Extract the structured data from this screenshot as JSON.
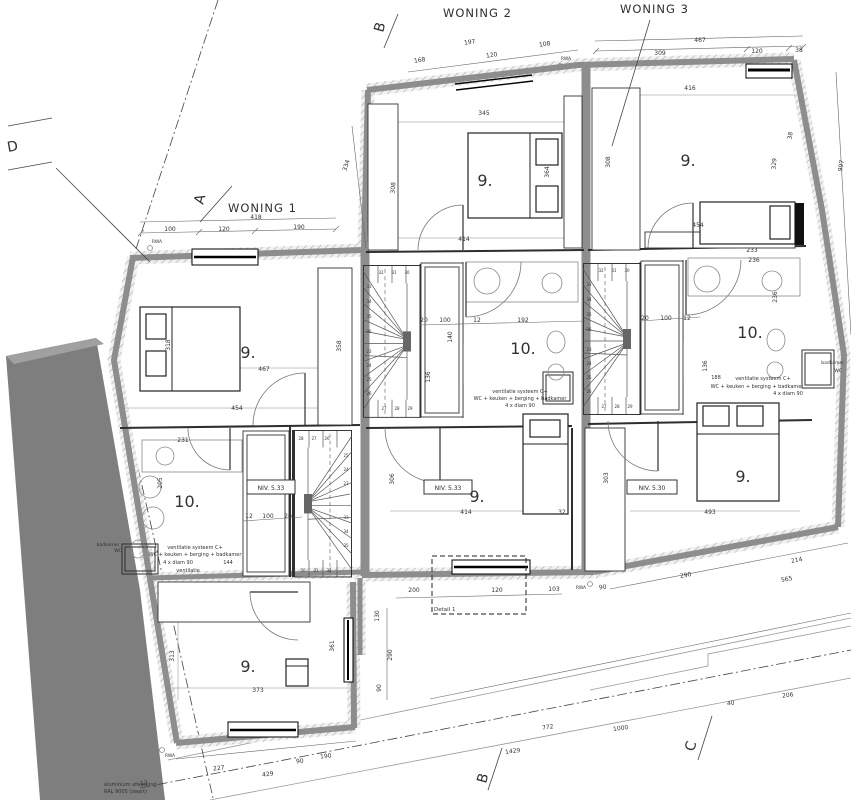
{
  "colors": {
    "wall_core": "#8d8d8d",
    "hatch_line": "#adadad",
    "neighbor_band": "#7e7e7e",
    "ink": "#2e2e2e",
    "dim": "#444444"
  },
  "labels": {
    "woning1": "WONING 1",
    "woning2": "WONING 2",
    "woning3": "WONING 3",
    "section_a": "A",
    "section_b_top": "B",
    "section_b_bottom": "B",
    "section_c": "C",
    "section_d": "D",
    "level_1": "NIV. 5.33",
    "level_2": "NIV. 5.33",
    "level_3": "NIV. 5.30"
  },
  "texts": [
    {
      "t": "9.",
      "x": 485,
      "y": 186,
      "s": 16,
      "n": "room-label"
    },
    {
      "t": "9.",
      "x": 688,
      "y": 166,
      "s": 16,
      "n": "room-label"
    },
    {
      "t": "9.",
      "x": 248,
      "y": 358,
      "s": 16,
      "n": "room-label"
    },
    {
      "t": "9.",
      "x": 477,
      "y": 502,
      "s": 16,
      "n": "room-label"
    },
    {
      "t": "9.",
      "x": 743,
      "y": 482,
      "s": 16,
      "n": "room-label"
    },
    {
      "t": "9.",
      "x": 248,
      "y": 672,
      "s": 16,
      "n": "room-label"
    },
    {
      "t": "10.",
      "x": 523,
      "y": 354,
      "s": 16,
      "n": "room-label"
    },
    {
      "t": "10.",
      "x": 750,
      "y": 338,
      "s": 16,
      "n": "room-label"
    },
    {
      "t": "10.",
      "x": 187,
      "y": 507,
      "s": 16,
      "n": "room-label"
    },
    {
      "t": "467",
      "x": 700,
      "y": 42
    },
    {
      "t": "309",
      "x": 660,
      "y": 55
    },
    {
      "t": "120",
      "x": 757,
      "y": 53
    },
    {
      "t": "38",
      "x": 799,
      "y": 52
    },
    {
      "t": "416",
      "x": 690,
      "y": 90
    },
    {
      "t": "197",
      "x": 470,
      "y": 44,
      "r": -9
    },
    {
      "t": "120",
      "x": 492,
      "y": 57,
      "r": -9
    },
    {
      "t": "108",
      "x": 545,
      "y": 46,
      "r": -9
    },
    {
      "t": "168",
      "x": 420,
      "y": 62,
      "r": -9
    },
    {
      "t": "418",
      "x": 256,
      "y": 219
    },
    {
      "t": "100",
      "x": 170,
      "y": 231
    },
    {
      "t": "120",
      "x": 224,
      "y": 231
    },
    {
      "t": "190",
      "x": 299,
      "y": 229
    },
    {
      "t": "345",
      "x": 484,
      "y": 115
    },
    {
      "t": "364",
      "x": 549,
      "y": 172,
      "r": -90
    },
    {
      "t": "414",
      "x": 464,
      "y": 241
    },
    {
      "t": "308",
      "x": 610,
      "y": 162,
      "r": -90
    },
    {
      "t": "454",
      "x": 698,
      "y": 227
    },
    {
      "t": "233",
      "x": 752,
      "y": 252
    },
    {
      "t": "236",
      "x": 754,
      "y": 262
    },
    {
      "t": "236",
      "x": 777,
      "y": 297,
      "r": -90
    },
    {
      "t": "38",
      "x": 792,
      "y": 136,
      "r": -80
    },
    {
      "t": "329",
      "x": 776,
      "y": 164,
      "r": -85
    },
    {
      "t": "997",
      "x": 843,
      "y": 166,
      "r": -80
    },
    {
      "t": "334",
      "x": 348,
      "y": 166,
      "r": -72
    },
    {
      "t": "308",
      "x": 395,
      "y": 188,
      "r": -85
    },
    {
      "t": "467",
      "x": 264,
      "y": 371
    },
    {
      "t": "454",
      "x": 237,
      "y": 410
    },
    {
      "t": "318",
      "x": 170,
      "y": 345,
      "r": -90
    },
    {
      "t": "358",
      "x": 341,
      "y": 346,
      "r": -90
    },
    {
      "t": "231",
      "x": 183,
      "y": 442
    },
    {
      "t": "205",
      "x": 162,
      "y": 483,
      "r": -90
    },
    {
      "t": "12",
      "x": 249,
      "y": 518
    },
    {
      "t": "100",
      "x": 268,
      "y": 518
    },
    {
      "t": "20",
      "x": 288,
      "y": 518
    },
    {
      "t": "20",
      "x": 424,
      "y": 322
    },
    {
      "t": "100",
      "x": 445,
      "y": 322
    },
    {
      "t": "12",
      "x": 477,
      "y": 322
    },
    {
      "t": "192",
      "x": 523,
      "y": 322
    },
    {
      "t": "140",
      "x": 452,
      "y": 337,
      "r": -90
    },
    {
      "t": "136",
      "x": 430,
      "y": 377,
      "r": -90
    },
    {
      "t": "20",
      "x": 645,
      "y": 320
    },
    {
      "t": "100",
      "x": 666,
      "y": 320
    },
    {
      "t": "12",
      "x": 687,
      "y": 320
    },
    {
      "t": "136",
      "x": 707,
      "y": 366,
      "r": -90
    },
    {
      "t": "414",
      "x": 466,
      "y": 514
    },
    {
      "t": "32",
      "x": 562,
      "y": 514
    },
    {
      "t": "303",
      "x": 608,
      "y": 478,
      "r": -90
    },
    {
      "t": "306",
      "x": 394,
      "y": 479,
      "r": -90
    },
    {
      "t": "493",
      "x": 710,
      "y": 514
    },
    {
      "t": "200",
      "x": 414,
      "y": 592
    },
    {
      "t": "120",
      "x": 497,
      "y": 592
    },
    {
      "t": "103",
      "x": 554,
      "y": 591
    },
    {
      "t": "90",
      "x": 603,
      "y": 589,
      "r": -8
    },
    {
      "t": "130",
      "x": 379,
      "y": 616,
      "r": -90
    },
    {
      "t": "290",
      "x": 392,
      "y": 655,
      "r": -90
    },
    {
      "t": "90",
      "x": 381,
      "y": 688,
      "r": -90
    },
    {
      "t": "290",
      "x": 686,
      "y": 577,
      "r": -10
    },
    {
      "t": "565",
      "x": 787,
      "y": 581,
      "r": -10
    },
    {
      "t": "214",
      "x": 797,
      "y": 562,
      "r": -10
    },
    {
      "t": "772",
      "x": 548,
      "y": 729,
      "r": -8
    },
    {
      "t": "1000",
      "x": 621,
      "y": 730,
      "r": -8
    },
    {
      "t": "1429",
      "x": 513,
      "y": 753,
      "r": -8
    },
    {
      "t": "206",
      "x": 788,
      "y": 697,
      "r": -8
    },
    {
      "t": "40",
      "x": 731,
      "y": 705,
      "r": -8
    },
    {
      "t": "227",
      "x": 219,
      "y": 770,
      "r": -6
    },
    {
      "t": "429",
      "x": 268,
      "y": 776,
      "r": -6
    },
    {
      "t": "90",
      "x": 300,
      "y": 763,
      "r": -6
    },
    {
      "t": "190",
      "x": 326,
      "y": 758,
      "r": -6
    },
    {
      "t": "12",
      "x": 144,
      "y": 785,
      "r": -6
    },
    {
      "t": "313",
      "x": 174,
      "y": 656,
      "r": -90
    },
    {
      "t": "373",
      "x": 258,
      "y": 692
    },
    {
      "t": "361",
      "x": 334,
      "y": 646,
      "r": -90
    },
    {
      "t": "188",
      "x": 716,
      "y": 379,
      "s": 5
    },
    {
      "t": "ventilatie systeem C+",
      "x": 520,
      "y": 393,
      "s": 5,
      "n": "annotation"
    },
    {
      "t": "WC + keuken + berging + badkamer",
      "x": 520,
      "y": 400,
      "s": 5,
      "n": "annotation"
    },
    {
      "t": "4 x diam 90",
      "x": 520,
      "y": 407,
      "s": 5,
      "n": "annotation"
    },
    {
      "t": "ventilatie systeem C+",
      "x": 763,
      "y": 380,
      "s": 5,
      "n": "annotation"
    },
    {
      "t": "WC + keuken + berging + badkamer",
      "x": 757,
      "y": 388,
      "s": 5,
      "n": "annotation"
    },
    {
      "t": "4 x diam 90",
      "x": 788,
      "y": 395,
      "s": 5,
      "n": "annotation"
    },
    {
      "t": "ventilatie systeem C+",
      "x": 195,
      "y": 549,
      "s": 5,
      "n": "annotation"
    },
    {
      "t": "WC + keuken + berging + badkamer",
      "x": 195,
      "y": 556,
      "s": 5,
      "n": "annotation"
    },
    {
      "t": "4 x diam 90",
      "x": 178,
      "y": 564,
      "s": 5,
      "n": "annotation"
    },
    {
      "t": "144",
      "x": 228,
      "y": 564,
      "s": 5,
      "n": "annotation"
    },
    {
      "t": "ventilatie",
      "x": 188,
      "y": 572,
      "s": 5,
      "n": "annotation"
    },
    {
      "t": "badkamer",
      "x": 108,
      "y": 546,
      "s": 4.5,
      "n": "annotation"
    },
    {
      "t": "WC",
      "x": 118,
      "y": 552,
      "s": 4.5,
      "n": "annotation"
    },
    {
      "t": "badkamer",
      "x": 844,
      "y": 364,
      "s": 4.5,
      "a": "e",
      "n": "annotation"
    },
    {
      "t": "WC",
      "x": 842,
      "y": 372,
      "s": 4.5,
      "a": "e",
      "n": "annotation"
    },
    {
      "t": "aluminium afwerking",
      "x": 104,
      "y": 786,
      "s": 5,
      "a": "s",
      "n": "annotation"
    },
    {
      "t": "RAL 9005 (zwart)",
      "x": 104,
      "y": 793,
      "s": 5,
      "a": "s",
      "n": "annotation"
    },
    {
      "t": "Detail 1",
      "x": 434,
      "y": 611,
      "s": 5.5,
      "a": "s",
      "n": "annotation"
    },
    {
      "t": "RWA",
      "x": 157,
      "y": 243,
      "s": 4.5,
      "n": "rwa-label"
    },
    {
      "t": "RWA",
      "x": 566,
      "y": 60,
      "s": 4.5,
      "n": "rwa-label"
    },
    {
      "t": "RWA",
      "x": 581,
      "y": 589,
      "s": 4.5,
      "n": "rwa-label"
    },
    {
      "t": "RWA",
      "x": 170,
      "y": 757,
      "s": 4.5,
      "n": "rwa-label"
    },
    {
      "t": "32",
      "x": 381,
      "y": 274,
      "s": 4,
      "n": "stair-step-number"
    },
    {
      "t": "31",
      "x": 394,
      "y": 274,
      "s": 4,
      "n": "stair-step-number"
    },
    {
      "t": "30",
      "x": 407,
      "y": 274,
      "s": 4,
      "n": "stair-step-number"
    },
    {
      "t": "33",
      "x": 369,
      "y": 288,
      "s": 4,
      "n": "stair-step-number"
    },
    {
      "t": "34",
      "x": 369,
      "y": 303,
      "s": 4,
      "n": "stair-step-number"
    },
    {
      "t": "35",
      "x": 369,
      "y": 318,
      "s": 4,
      "n": "stair-step-number"
    },
    {
      "t": "36",
      "x": 369,
      "y": 333,
      "s": 4,
      "n": "stair-step-number"
    },
    {
      "t": "23",
      "x": 369,
      "y": 353,
      "s": 4,
      "n": "stair-step-number"
    },
    {
      "t": "24",
      "x": 369,
      "y": 367,
      "s": 4,
      "n": "stair-step-number"
    },
    {
      "t": "25",
      "x": 369,
      "y": 381,
      "s": 4,
      "n": "stair-step-number"
    },
    {
      "t": "26",
      "x": 369,
      "y": 395,
      "s": 4,
      "n": "stair-step-number"
    },
    {
      "t": "27",
      "x": 384,
      "y": 410,
      "s": 4,
      "n": "stair-step-number"
    },
    {
      "t": "28",
      "x": 397,
      "y": 410,
      "s": 4,
      "n": "stair-step-number"
    },
    {
      "t": "29",
      "x": 410,
      "y": 410,
      "s": 4,
      "n": "stair-step-number"
    },
    {
      "t": "32",
      "x": 601,
      "y": 272,
      "s": 4,
      "n": "stair-step-number"
    },
    {
      "t": "31",
      "x": 614,
      "y": 272,
      "s": 4,
      "n": "stair-step-number"
    },
    {
      "t": "30",
      "x": 627,
      "y": 272,
      "s": 4,
      "n": "stair-step-number"
    },
    {
      "t": "33",
      "x": 589,
      "y": 286,
      "s": 4,
      "n": "stair-step-number"
    },
    {
      "t": "34",
      "x": 589,
      "y": 301,
      "s": 4,
      "n": "stair-step-number"
    },
    {
      "t": "35",
      "x": 589,
      "y": 316,
      "s": 4,
      "n": "stair-step-number"
    },
    {
      "t": "36",
      "x": 589,
      "y": 331,
      "s": 4,
      "n": "stair-step-number"
    },
    {
      "t": "23",
      "x": 589,
      "y": 351,
      "s": 4,
      "n": "stair-step-number"
    },
    {
      "t": "24",
      "x": 589,
      "y": 365,
      "s": 4,
      "n": "stair-step-number"
    },
    {
      "t": "25",
      "x": 589,
      "y": 379,
      "s": 4,
      "n": "stair-step-number"
    },
    {
      "t": "26",
      "x": 589,
      "y": 393,
      "s": 4,
      "n": "stair-step-number"
    },
    {
      "t": "27",
      "x": 604,
      "y": 408,
      "s": 4,
      "n": "stair-step-number"
    },
    {
      "t": "28",
      "x": 617,
      "y": 408,
      "s": 4,
      "n": "stair-step-number"
    },
    {
      "t": "29",
      "x": 630,
      "y": 408,
      "s": 4,
      "n": "stair-step-number"
    },
    {
      "t": "28",
      "x": 301,
      "y": 440,
      "s": 4,
      "n": "stair-step-number"
    },
    {
      "t": "27",
      "x": 314,
      "y": 440,
      "s": 4,
      "n": "stair-step-number"
    },
    {
      "t": "26",
      "x": 327,
      "y": 440,
      "s": 4,
      "n": "stair-step-number"
    },
    {
      "t": "25",
      "x": 346,
      "y": 457,
      "s": 4,
      "n": "stair-step-number"
    },
    {
      "t": "24",
      "x": 346,
      "y": 471,
      "s": 4,
      "n": "stair-step-number"
    },
    {
      "t": "23",
      "x": 346,
      "y": 485,
      "s": 4,
      "n": "stair-step-number"
    },
    {
      "t": "33",
      "x": 346,
      "y": 519,
      "s": 4,
      "n": "stair-step-number"
    },
    {
      "t": "34",
      "x": 346,
      "y": 533,
      "s": 4,
      "n": "stair-step-number"
    },
    {
      "t": "35",
      "x": 346,
      "y": 547,
      "s": 4,
      "n": "stair-step-number"
    },
    {
      "t": "30",
      "x": 303,
      "y": 572,
      "s": 4,
      "n": "stair-step-number"
    },
    {
      "t": "31",
      "x": 316,
      "y": 572,
      "s": 4,
      "n": "stair-step-number"
    },
    {
      "t": "32",
      "x": 329,
      "y": 572,
      "s": 4,
      "n": "stair-step-number"
    }
  ]
}
